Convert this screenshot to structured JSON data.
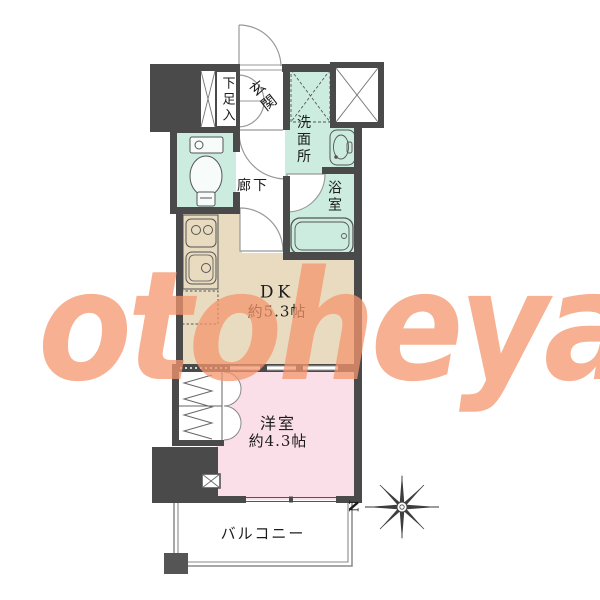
{
  "watermark": {
    "text": "otoheya",
    "color": "#f4956c"
  },
  "compass": {
    "north": "N"
  },
  "rooms": {
    "shoe_storage": "下足入",
    "entrance": "玄関",
    "washroom": "洗面所",
    "bathroom": "浴室",
    "hallway": "廊下",
    "dk": "DK",
    "dk_size": "約5.3帖",
    "western_room": "洋室",
    "western_room_size": "約4.3帖",
    "balcony": "バルコニー"
  },
  "colors": {
    "wet_area": "#cbecdf",
    "dining_kitchen": "#e8dbbf",
    "western_room": "#fbdfe8",
    "wall": "#4a4a4a",
    "watermark": "#f4956c"
  }
}
